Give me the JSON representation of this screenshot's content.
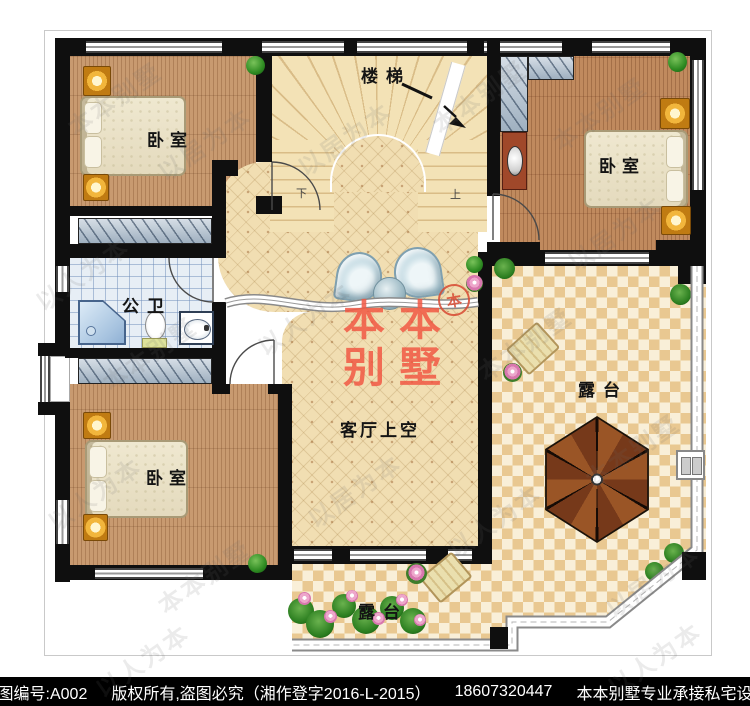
{
  "rooms": {
    "bedroom_tl": {
      "label": "卧室"
    },
    "bedroom_tr": {
      "label": "卧室"
    },
    "bedroom_bl": {
      "label": "卧室"
    },
    "bathroom": {
      "label": "公卫"
    },
    "stairs": {
      "label": "楼梯"
    },
    "living_void": {
      "label": "客厅上空"
    },
    "terrace_right": {
      "label": "露台"
    },
    "terrace_bottom": {
      "label": "露台"
    }
  },
  "stairs_marks": {
    "down": "下",
    "up": "上"
  },
  "logo": {
    "line1": "本本",
    "line2": "别墅",
    "stamp": "本"
  },
  "footer": {
    "segments": [
      "本图编号:A002",
      "版权所有,盗图必究（湘作登字2016-L-2015）",
      "18607320447",
      "本本别墅专业承接私宅设计"
    ]
  },
  "colors": {
    "logo_red": "#f25743",
    "wall_black": "#0f0f0f",
    "wood_floor": "#c89a70",
    "hall_tile": "#f1deb2",
    "checker_dark": "#e9c891",
    "checker_light": "#f9efd8",
    "bath_tile": "#e7eef5",
    "closet_hatch": "#b9c7d6",
    "lamp_orange": "#f2b63c",
    "plant_green": "#2e8b22"
  },
  "watermarks": [
    {
      "text": "本本别墅",
      "x": 60,
      "y": 80
    },
    {
      "text": "以居为本",
      "x": 150,
      "y": 125
    },
    {
      "text": "以人为本",
      "x": 28,
      "y": 255
    },
    {
      "text": "本本别墅",
      "x": 95,
      "y": 335
    },
    {
      "text": "以人为本",
      "x": 40,
      "y": 475
    },
    {
      "text": "本本别墅",
      "x": 150,
      "y": 558
    },
    {
      "text": "以居为本",
      "x": 290,
      "y": 120
    },
    {
      "text": "本本别墅",
      "x": 425,
      "y": 78
    },
    {
      "text": "以人为本",
      "x": 250,
      "y": 300
    },
    {
      "text": "以居为本",
      "x": 300,
      "y": 472
    },
    {
      "text": "本本别墅",
      "x": 545,
      "y": 95
    },
    {
      "text": "以居为本",
      "x": 560,
      "y": 215
    },
    {
      "text": "本本别墅",
      "x": 470,
      "y": 325
    },
    {
      "text": "以人为本",
      "x": 440,
      "y": 502
    },
    {
      "text": "本本别墅",
      "x": 578,
      "y": 432
    },
    {
      "text": "以居为本",
      "x": 598,
      "y": 562
    },
    {
      "text": "以人为本",
      "x": 88,
      "y": 642
    },
    {
      "text": "以人为本",
      "x": 600,
      "y": 640
    }
  ]
}
